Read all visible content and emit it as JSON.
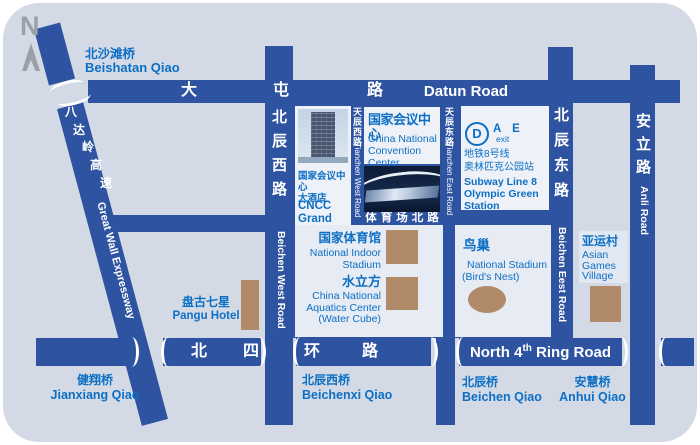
{
  "colors": {
    "map_background": "#d3dae6",
    "road_blue": "#2e53a1",
    "label_blue": "#0d6fc4",
    "landmark_brown": "#b18a6a",
    "box_light": "#e6ebf4",
    "box_white": "#eef2f8",
    "compass_gray": "#9aa0a6",
    "road_text": "#ffffff"
  },
  "compass": {
    "letter": "N"
  },
  "roads": {
    "datun": {
      "zh": [
        "大",
        "屯",
        "路"
      ],
      "en": "Datun Road"
    },
    "north_4th_ring": {
      "zh": [
        "北",
        "四",
        "环",
        "路"
      ],
      "en_pre": "North 4",
      "en_sup": "th",
      "en_post": " Ring Road"
    },
    "great_wall_expressway": {
      "zh": [
        "八",
        "达",
        "岭",
        "高",
        "速"
      ],
      "en": "Great Wall Expressway"
    },
    "beichen_west": {
      "zh": "北辰西路",
      "en": "Beichen West Road"
    },
    "tianchen_west": {
      "zh": "天辰西路",
      "en": "Tianchen West Road"
    },
    "tianchen_east": {
      "zh": "天辰东路",
      "en": "Tianchen East Road"
    },
    "beichen_east": {
      "zh": "北辰东路",
      "en": "Beichen Eest Road"
    },
    "anli": {
      "zh": "安立路",
      "en": "Anli Road"
    },
    "stadium_north": {
      "zh": "体育场北路"
    }
  },
  "bridges": {
    "beishatan": {
      "zh": "北沙滩桥",
      "en": "Beishatan Qiao"
    },
    "jianxiang": {
      "zh": "健翔桥",
      "en": "Jianxiang Qiao"
    },
    "beichenxi": {
      "zh": "北辰西桥",
      "en": "Beichenxi Qiao"
    },
    "beichen": {
      "zh": "北辰桥",
      "en": "Beichen Qiao"
    },
    "anhui": {
      "zh": "安慧桥",
      "en": "Anhui Qiao"
    }
  },
  "places": {
    "cncc_hotel": {
      "zh1": "国家会议中心",
      "zh2": "大酒店",
      "en1": "CNCC",
      "en2": "Grand Hotel"
    },
    "cncc": {
      "zh": "国家会议中心",
      "en1": "China National",
      "en2": "Convention Center"
    },
    "indoor_stadium": {
      "zh": "国家体育馆",
      "en1": "National Indoor",
      "en2": "Stadium"
    },
    "water_cube": {
      "zh": "水立方",
      "en1": "China National",
      "en2": "Aquatics Center",
      "en3": "(Water Cube)"
    },
    "birds_nest": {
      "zh": "鸟巢",
      "en1": "National Stadium",
      "en2": "(Bird's Nest)"
    },
    "asian_games_village": {
      "zh": "亚运村",
      "en1": "Asian",
      "en2": "Games",
      "en3": "Village"
    },
    "pangu_hotel": {
      "zh": "盘古七星",
      "en": "Pangu Hotel"
    }
  },
  "subway": {
    "logo_letter": "D",
    "exits": "A E",
    "exit_word": "exit",
    "line_zh": "地铁8号线",
    "station_zh": "奥林匹克公园站",
    "line_en": "Subway Line 8",
    "station_en1": "Olympic Green",
    "station_en2": "Station"
  }
}
